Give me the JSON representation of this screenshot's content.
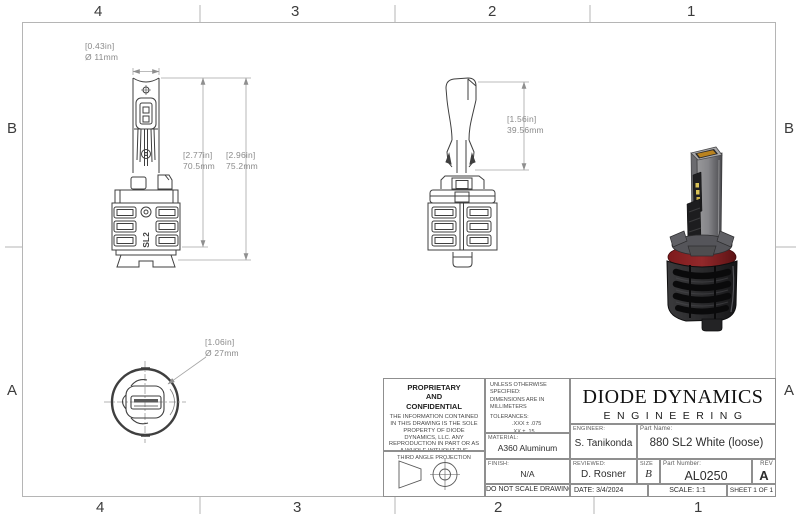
{
  "sheet": {
    "zones_top": [
      "4",
      "3",
      "2",
      "1"
    ],
    "zones_bottom": [
      "4",
      "3",
      "2",
      "1"
    ],
    "zones_left": [
      "B",
      "A"
    ],
    "zones_right": [
      "B",
      "A"
    ]
  },
  "dimensions": {
    "front_top": {
      "in": "[0.43in]",
      "mm": "Ø 11mm"
    },
    "front_height_inner": {
      "in": "[2.77in]",
      "mm": "70.5mm"
    },
    "front_height_outer": {
      "in": "[2.96in]",
      "mm": "75.2mm"
    },
    "side_height": {
      "in": "[1.56in]",
      "mm": "39.56mm"
    },
    "bottom_diameter": {
      "in": "[1.06in]",
      "mm": "Ø 27mm"
    }
  },
  "front_view": {
    "logo_text": "SL2"
  },
  "title_block": {
    "proprietary_title_lines": [
      "PROPRIETARY",
      "AND",
      "CONFIDENTIAL"
    ],
    "proprietary_body": "THE INFORMATION CONTAINED IN THIS DRAWING IS THE SOLE PROPERTY OF DIODE DYNAMICS, LLC.  ANY REPRODUCTION IN PART OR AS A WHOLE WITHOUT THE WRITTEN PERMISSION OF DIODE DYNAMICS, LLC. IS PROHIBITED.",
    "projection_label": "THIRD ANGLE PROJECTION",
    "specs": {
      "unless": "UNLESS OTHERWISE SPECIFIED:",
      "dims_in": "DIMENSIONS ARE IN MILLIMETERS",
      "tolerances_label": "TOLERANCES:",
      "tolerances": [
        ".XXX ± .075",
        ".XX ± .15",
        ".X ± .3",
        "± .5",
        "ANG ± 1"
      ]
    },
    "material_label": "MATERIAL:",
    "material": "A360 Aluminum",
    "finish_label": "FINISH:",
    "finish": "N/A",
    "do_not_scale": "DO NOT SCALE DRAWING",
    "logo_line1": "DIODE DYNAMICS",
    "logo_line2": "ENGINEERING",
    "engineer_label": "ENGINEER:",
    "engineer": "S. Tanikonda",
    "part_name_label": "Part Name:",
    "part_name": "880 SL2 White (loose)",
    "reviewed_label": "REVIEWED:",
    "reviewed": "D. Rosner",
    "size_label": "SIZE",
    "size": "B",
    "part_number_label": "Part Number:",
    "part_number": "AL0250",
    "rev_label": "REV",
    "rev": "A",
    "date_label": "DATE:",
    "date": "3/4/2024",
    "scale": "SCALE: 1:1",
    "sheet": "SHEET 1 OF 1"
  },
  "colors": {
    "part_line": "#3f3f3f",
    "dim_line": "#a5a5a5",
    "border_line": "#b5b5b5",
    "oring_red": "#8a2022",
    "led_amber": "#b9821f",
    "chip_yellow": "#d9c257",
    "render_body_gray": "#86868a",
    "render_sink_black": "#1c1c1e"
  }
}
